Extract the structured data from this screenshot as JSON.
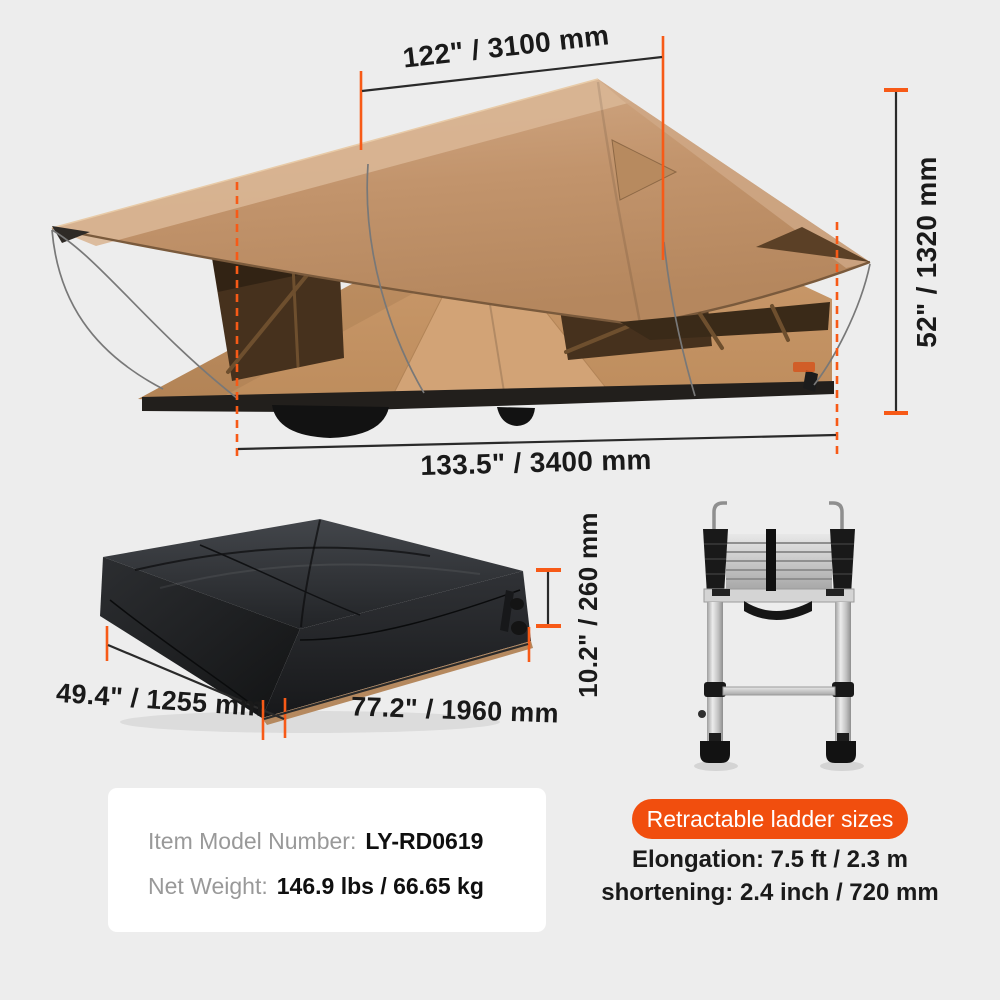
{
  "colors": {
    "page-bg": "#ededed",
    "accent-orange": "#f75a17",
    "badge-orange": "#f14e0e",
    "dim-line": "#2a2a2a",
    "text-dark": "#1a1a1a",
    "label-gray": "#999999",
    "card-bg": "#ffffff",
    "tent-tan": "#c2946c",
    "tent-tan-light": "#d9b695",
    "window-brown": "#46311d",
    "pack-black": "#232528",
    "ladder-silver": "#c9c9c9"
  },
  "tent": {
    "dims": {
      "top_width": "122\" / 3100 mm",
      "height": "52\" / 1320 mm",
      "bottom_length": "133.5\" / 3400 mm"
    }
  },
  "packed_tent": {
    "dims": {
      "width": "49.4\" / 1255 mm",
      "length": "77.2\" / 1960 mm",
      "height": "10.2\" / 260 mm"
    }
  },
  "info_card": {
    "model_label": "Item Model Number:",
    "model_value": "LY-RD0619",
    "weight_label": "Net Weight:",
    "weight_value": "146.9 lbs / 66.65 kg"
  },
  "ladder_info": {
    "badge_label": "Retractable ladder sizes",
    "elongation": "Elongation: 7.5 ft / 2.3 m",
    "shortening": "shortening: 2.4 inch / 720 mm"
  }
}
